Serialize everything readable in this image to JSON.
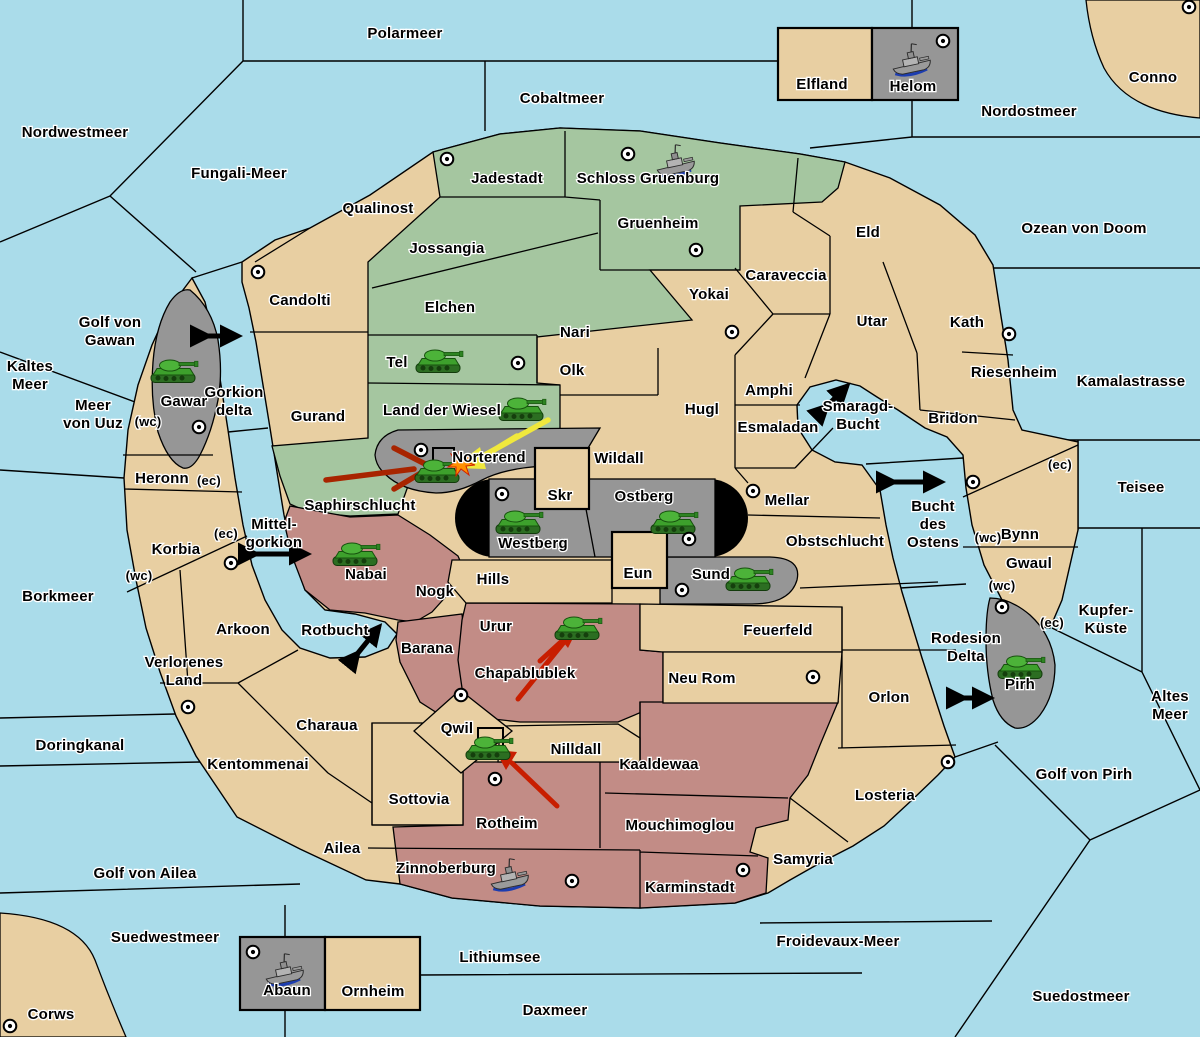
{
  "palette": {
    "sea": "#aadcea",
    "land": "#e8cfa2",
    "green": "#a5c6a0",
    "red": "#c28c86",
    "gray": "#969696",
    "gray_dark": "#8c8c8c",
    "yellow_arrow": "#f0e83c",
    "dark_red_arrow": "#a82400",
    "red_arrow": "#c81e00",
    "tank_green": "#3da02c",
    "ship_gray": "#9a9a9a"
  },
  "labels": {
    "polarmeer": "Polarmeer",
    "nordwestmeer": "Nordwestmeer",
    "fungali": "Fungali-Meer",
    "cobaltmeer": "Cobaltmeer",
    "nordostmeer": "Nordostmeer",
    "conno": "Conno",
    "elfland": "Elfland",
    "helom": "Helom",
    "ozean": "Ozean von Doom",
    "kamalastrasse": "Kamalastrasse",
    "teisee": "Teisee",
    "kupfer1": "Kupfer-",
    "kupfer2": "Küste",
    "altes1": "Altes",
    "altes2": "Meer",
    "golfpirh": "Golf von Pirh",
    "suedostmeer": "Suedostmeer",
    "froidevaux": "Froidevaux-Meer",
    "daxmeer": "Daxmeer",
    "lithiumsee": "Lithiumsee",
    "suedwestmeer": "Suedwestmeer",
    "corws": "Corws",
    "golfailea": "Golf von Ailea",
    "doringkanal": "Doringkanal",
    "borkmeer": "Borkmeer",
    "kaltes1": "Kaltes",
    "kaltes2": "Meer",
    "uuz1": "Meer",
    "uuz2": "von Uuz",
    "gawan1": "Golf von",
    "gawan2": "Gawan",
    "gorkion1": "Gorkion",
    "gorkion2": "delta",
    "mittel1": "Mittel-",
    "mittel2": "gorkion",
    "rotbucht": "Rotbucht",
    "smaragd1": "Smaragd-",
    "smaragd2": "Bucht",
    "ostens1": "Bucht",
    "ostens2": "des",
    "ostens3": "Ostens",
    "rodesion1": "Rodesion",
    "rodesion2": "Delta",
    "qualinost": "Qualinost",
    "candolti": "Candolti",
    "gurand": "Gurand",
    "heronn": "Heronn",
    "korbia": "Korbia",
    "arkoon": "Arkoon",
    "verloren1": "Verlorenes",
    "verloren2": "Land",
    "charaua": "Charaua",
    "kentommenai": "Kentommenai",
    "ailea": "Ailea",
    "sottovia": "Sottovia",
    "qwil": "Qwil",
    "nilldall": "Nilldall",
    "hills": "Hills",
    "skr": "Skr",
    "eun": "Eun",
    "wildall": "Wildall",
    "hugl": "Hugl",
    "olk": "Olk",
    "yokai": "Yokai",
    "caraveccia": "Caraveccia",
    "eld": "Eld",
    "utar": "Utar",
    "kath": "Kath",
    "riesenheim": "Riesenheim",
    "bridon": "Bridon",
    "bynn": "Bynn",
    "gwaul": "Gwaul",
    "amphi": "Amphi",
    "esmaladan": "Esmaladan",
    "mellar": "Mellar",
    "obstschlucht": "Obstschlucht",
    "orlon": "Orlon",
    "losteria": "Losteria",
    "samyria": "Samyria",
    "neurom": "Neu Rom",
    "feuerfeld": "Feuerfeld",
    "ornheim": "Ornheim",
    "jadestadt": "Jadestadt",
    "schloss": "Schloss Gruenburg",
    "gruenheim": "Gruenheim",
    "jossangia": "Jossangia",
    "elchen": "Elchen",
    "tel": "Tel",
    "ldw": "Land der Wiesel",
    "nari": "Nari",
    "saphirschlucht": "Saphirschlucht",
    "nabai": "Nabai",
    "nogk": "Nogk",
    "barana": "Barana",
    "urur": "Urur",
    "chapablublek": "Chapablublek",
    "rotheim": "Rotheim",
    "kaaldewaa": "Kaaldewaa",
    "mouchimoglou": "Mouchimoglou",
    "zinnoberburg": "Zinnoberburg",
    "karminstadt": "Karminstadt",
    "gawar": "Gawar",
    "norterend": "Norterend",
    "westberg": "Westberg",
    "ostberg": "Ostberg",
    "sund": "Sund",
    "pirh": "Pirh",
    "abaun": "Abaun",
    "wc": "(wc)",
    "ec": "(ec)"
  },
  "units": {
    "armies": [
      "Gawar",
      "Tel",
      "Land der Wiesel",
      "Norterend",
      "Westberg",
      "Ostberg",
      "Sund",
      "Nabai",
      "Urur",
      "Qwil",
      "Pirh"
    ],
    "fleets": [
      "Schloss Gruenburg",
      "Helom",
      "Zinnoberburg",
      "Abaun"
    ]
  },
  "supply_centers": [
    "Jadestadt",
    "Schloss Gruenburg",
    "Gruenheim",
    "Candolti",
    "Yokai",
    "Kath",
    "Tel",
    "Gawar",
    "Norterend",
    "Westberg",
    "Mellar",
    "Ostberg",
    "Sund",
    "Arkoon",
    "Verlorenes Land",
    "Corws",
    "Abaun",
    "Zinnoberburg",
    "Karminstadt",
    "Rotheim",
    "Qwil",
    "Neu Rom",
    "Losteria",
    "Pirh",
    "Bynn",
    "Helom",
    "Conno"
  ],
  "arrows": {
    "yellow_move": "Land der Wiesel to Norterend",
    "dark_red_move": "Saphirschlucht to Norterend",
    "red_moves": [
      "Chapablublek to Urur",
      "Rotheim to Qwil"
    ],
    "straits": [
      "Gorkion delta",
      "Mittel-gorkion",
      "Rotbucht",
      "Smaragd-Bucht",
      "Bucht des Ostens",
      "Rodesion Delta"
    ]
  }
}
